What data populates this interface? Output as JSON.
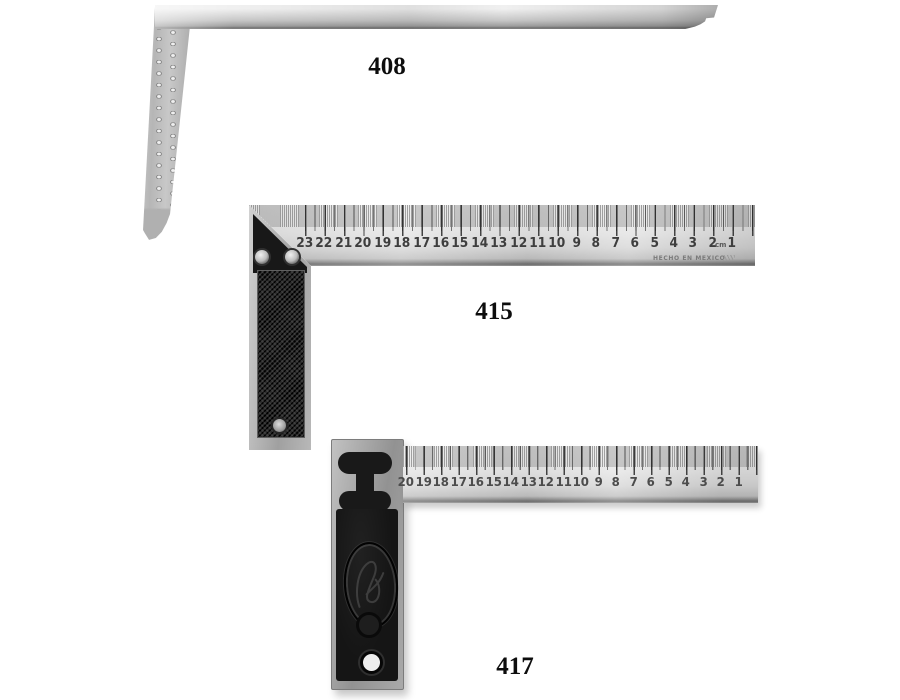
{
  "page": {
    "background": "#ffffff"
  },
  "square408": {
    "label": "408",
    "features": [
      "steel-framing-blade",
      "perforated-arm",
      "decorative-cove-end"
    ]
  },
  "square415": {
    "label": "415",
    "scale_numbers": [
      "23",
      "22",
      "21",
      "20",
      "19",
      "18",
      "17",
      "16",
      "15",
      "14",
      "13",
      "12",
      "11",
      "10",
      "9",
      "8",
      "7",
      "6",
      "5",
      "4",
      "3",
      "2",
      "1"
    ],
    "unit": "cm",
    "origin_stamp": "HECHO EN MEXICO",
    "features": [
      "mitered-try-square-blade",
      "knurled-black-handle-inlay",
      "two-rivets",
      "hanging-hole"
    ]
  },
  "square417": {
    "label": "417",
    "scale_numbers": [
      "20",
      "19",
      "18",
      "17",
      "16",
      "15",
      "14",
      "13",
      "12",
      "11",
      "10",
      "9",
      "8",
      "7",
      "6",
      "5",
      "4",
      "3",
      "2",
      "1"
    ],
    "features": [
      "try-square-blade",
      "cast-iron-handle",
      "oval-script-emblem",
      "hanging-hole"
    ]
  },
  "colors": {
    "metal_light": "#ebebeb",
    "metal_mid": "#c0c0c0",
    "metal_dark": "#6f6f6f",
    "handle_dark": "#151515",
    "label_text": "#0d0d0d",
    "scale_text": "#3e3e3e"
  }
}
